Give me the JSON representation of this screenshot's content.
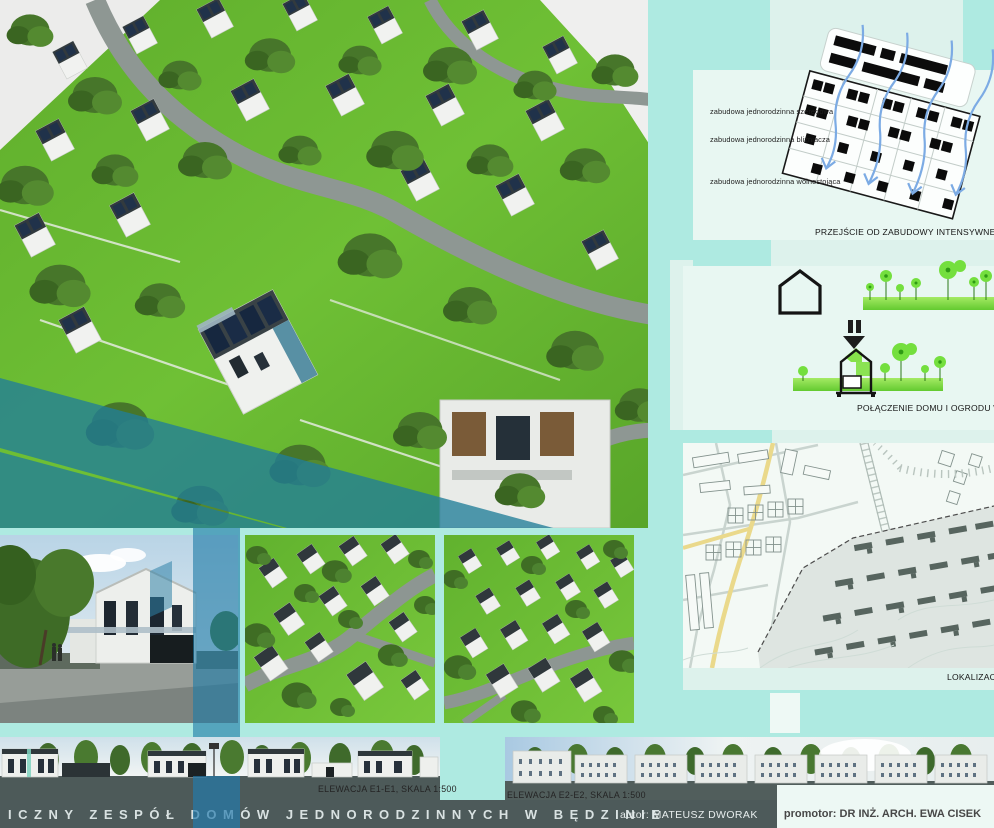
{
  "right_panel": {
    "typology": {
      "labels": [
        "zabudowa jednorodzinna szeregowa",
        "zabudowa jednorodzinna bliźniacza",
        "zabudowa jednorodzinna wolnostojąca"
      ],
      "caption": "PRZEJŚCIE OD ZABUDOWY INTENSYWNEJ DO E"
    },
    "house_garden": {
      "plus_sign": "+",
      "caption": "POŁĄCZENIE DOMU I OGRODU W JED"
    },
    "site_plan": {
      "caption": "LOKALIZACJA"
    }
  },
  "elevations": {
    "e1_label": "ELEWACJA E1-E1, SKALA 1:500",
    "e2_label": "ELEWACJA E2-E2, SKALA 1:500"
  },
  "footer": {
    "title": "ICZNY ZESPÓŁ DOMÓW JEDNORODZINNYCH W BĘDZINIE",
    "author": "autor: MATEUSZ DWORAK",
    "promoter": "promotor: DR INŻ. ARCH. EWA CISEK"
  },
  "colors": {
    "teal_patch": "#aeeae1",
    "mint_base": "#ddf2ec",
    "panel_light": "#e8f7f2",
    "map_bg": "#f3f9f5",
    "footer_bar": "#4d5a5a",
    "blue_band": "#1e7aa6",
    "grass_green": "#66b92f",
    "diagram_green": "#7fdd45",
    "arrow_blue": "#7cabe4"
  }
}
